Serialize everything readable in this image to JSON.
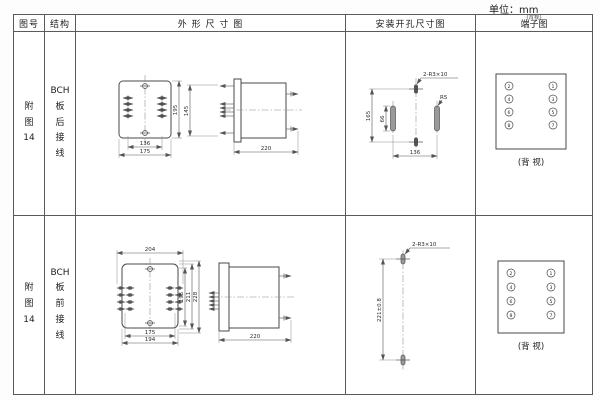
{
  "unit_label": "单位：mm",
  "headers": {
    "fig_no": "图号",
    "structure": "结构",
    "outline": "外 形 尺 寸 图",
    "mounting": "安装开孔尺寸图",
    "terminal": "端子图",
    "terminal_small": "(背视)"
  },
  "rows": [
    {
      "fig_no": "附\n图\n14",
      "structure": "BCH\n板\n后\n接\n线",
      "outline": {
        "front_width_inner": "136",
        "front_width_outer": "175",
        "front_height": "195",
        "side_height": "145",
        "side_depth": "220"
      },
      "mounting": {
        "hole_label": "2-R3×10",
        "slot_label": "R5",
        "height": "165",
        "slot_height": "66",
        "width": "136"
      },
      "terminal": {
        "left": [
          "2",
          "4",
          "6",
          "8"
        ],
        "right": [
          "1",
          "3",
          "5",
          "7"
        ],
        "caption": "(背 视)"
      }
    },
    {
      "fig_no": "附\n图\n14",
      "structure": "BCH\n板\n前\n接\n线",
      "outline": {
        "front_top": "204",
        "front_width_inner": "175",
        "front_width_outer": "194",
        "h1": "195",
        "h2": "211",
        "h3": "228",
        "side_depth": "220"
      },
      "mounting": {
        "hole_label": "2-R3×10",
        "height": "221±0.8"
      },
      "terminal": {
        "left": [
          "2",
          "4",
          "6",
          "8"
        ],
        "right": [
          "1",
          "3",
          "5",
          "7"
        ],
        "caption": "(背 视)"
      }
    }
  ]
}
